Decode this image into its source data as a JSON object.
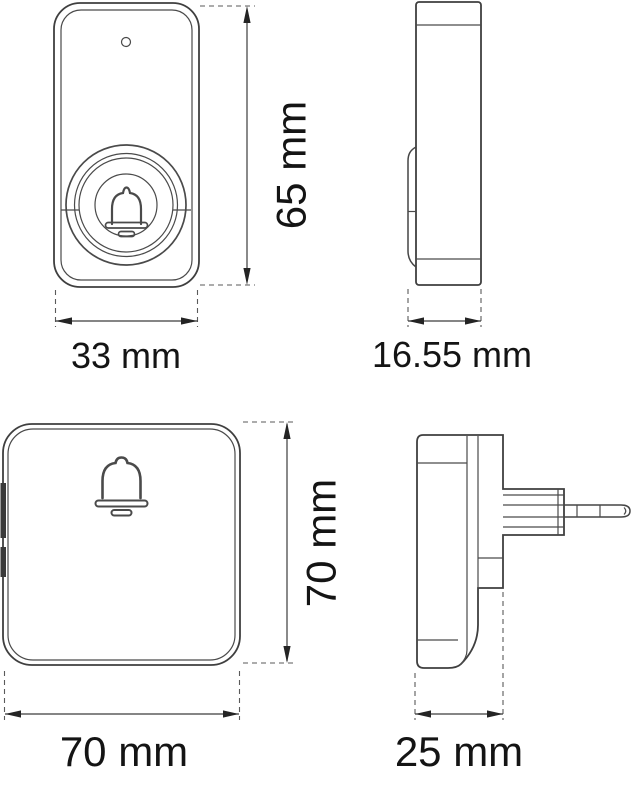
{
  "page": {
    "background_color": "#ffffff"
  },
  "drawing": {
    "type": "technical-dimension-drawing",
    "subject": "wireless doorbell push button and plug-in chime, four orthographic views",
    "line_color": "#3f3f3f",
    "text_color": "#141414",
    "dims": {
      "button_height": "65 mm",
      "button_width": "33 mm",
      "button_depth": "16.55 mm",
      "chime_height": "70 mm",
      "chime_width": "70 mm",
      "chime_depth": "25 mm"
    }
  }
}
